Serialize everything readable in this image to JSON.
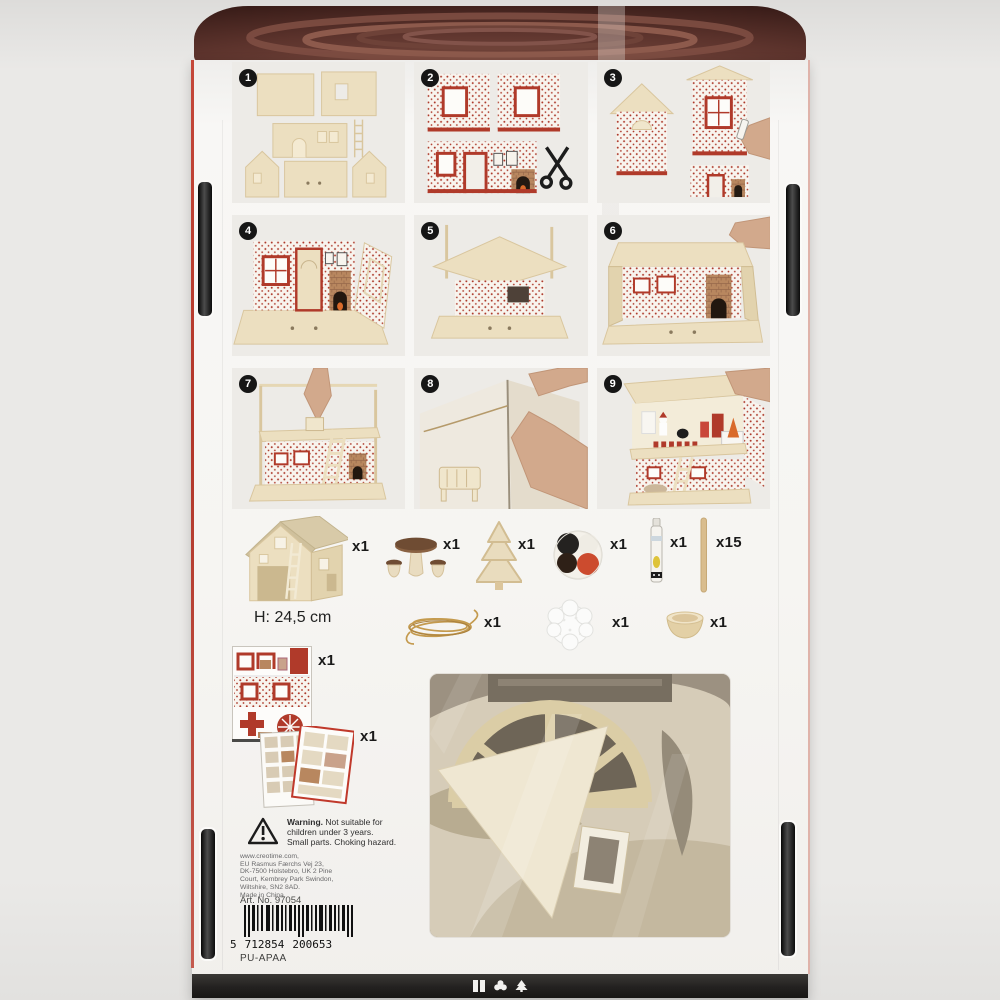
{
  "product": {
    "steps": [
      "1",
      "2",
      "3",
      "4",
      "5",
      "6",
      "7",
      "8",
      "9"
    ],
    "contents": {
      "house": "x1",
      "height": "H: 24,5 cm",
      "table": "x1",
      "tree": "x1",
      "paint": "x1",
      "glue": "x1",
      "sticks": "x15",
      "twine": "x1",
      "snow": "x1",
      "bowl": "x1",
      "stickers": "x1",
      "booklet": "x1"
    },
    "warning": {
      "bold": "Warning.",
      "line1_rest": " Not suitable for",
      "line2": "children under 3 years.",
      "line3": "Small parts. Choking hazard."
    },
    "address": [
      "www.creotime.com,",
      "EU Rasmus Færchs Vej 23,",
      "DK-7500 Holstebro, UK 2 Pine",
      "Court, Kembrey Park Swindon,",
      "Wiltshire, SN2 8AD.",
      "Made in China."
    ],
    "art_no": "Art. No. 97054",
    "barcode": {
      "prefix": "5",
      "group1": "712854",
      "group2": "200653"
    },
    "packing_code": "PU-APAA"
  },
  "colors": {
    "accent_red": "#b03a2a",
    "wood": "#ecdfc0",
    "lid_maroon": "#4a2723"
  }
}
